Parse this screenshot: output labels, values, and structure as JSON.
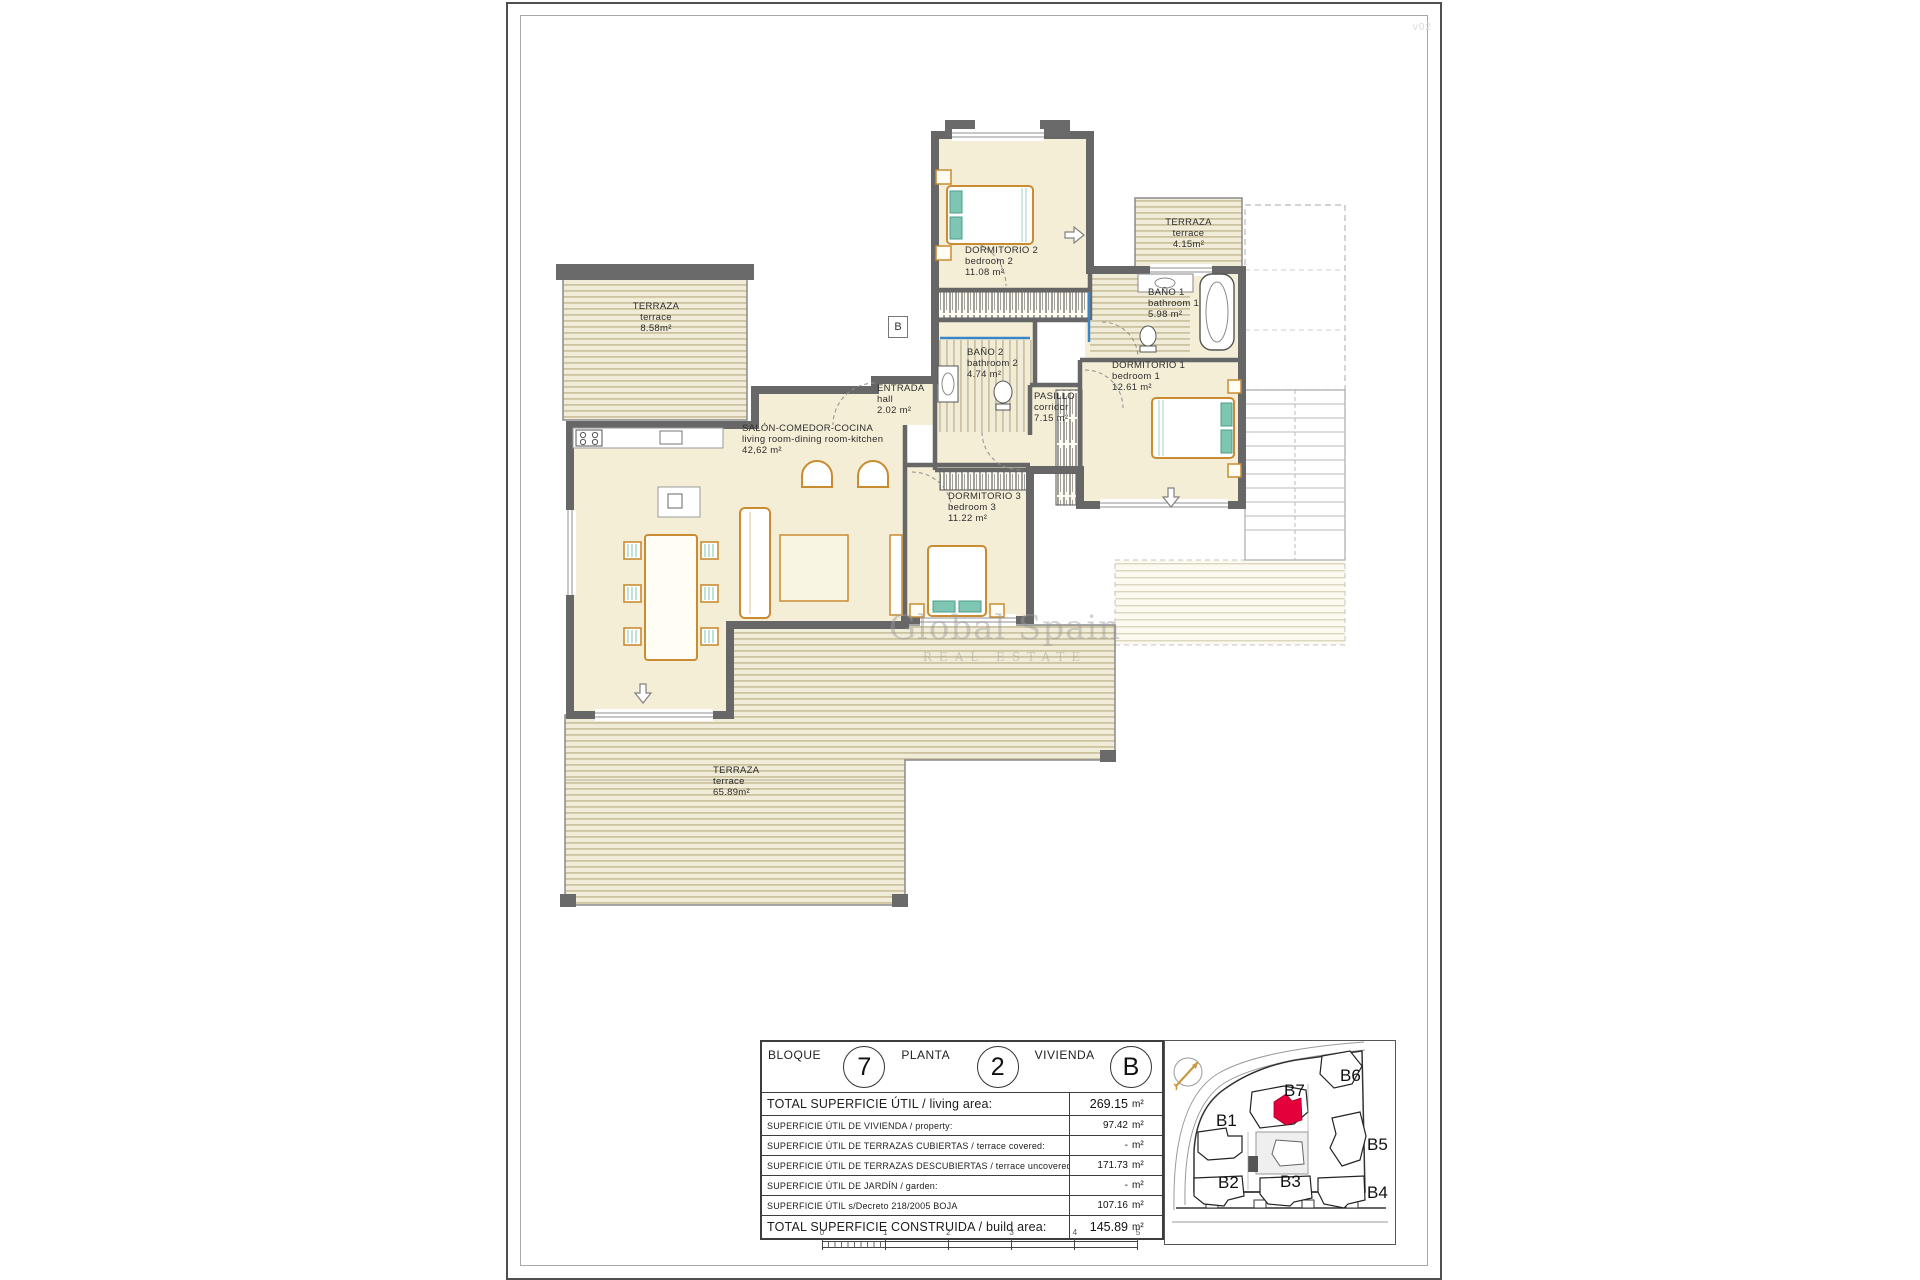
{
  "page": {
    "corner_note": "v02"
  },
  "watermark": {
    "line1": "Global Spain",
    "line2": "REAL ESTATE"
  },
  "plan": {
    "unit_marker": "B",
    "rooms": {
      "terraza_left": {
        "es": "TERRAZA",
        "en": "terrace",
        "area": "8.58m²"
      },
      "dorm2": {
        "es": "DORMITORIO 2",
        "en": "bedroom 2",
        "area": "11.08 m²"
      },
      "terraza_top": {
        "es": "TERRAZA",
        "en": "terrace",
        "area": "4.15m²"
      },
      "bano1": {
        "es": "BAÑO 1",
        "en": "bathroom 1",
        "area": "5.98 m²"
      },
      "dorm1": {
        "es": "DORMITORIO 1",
        "en": "bedroom 1",
        "area": "12.61 m²"
      },
      "pasillo": {
        "es": "PASILLO",
        "en": "corridor",
        "area": "7.15 m²"
      },
      "bano2": {
        "es": "BAÑO 2",
        "en": "bathroom 2",
        "area": "4.74 m²"
      },
      "entrada": {
        "es": "ENTRADA",
        "en": "hall",
        "area": "2.02 m²"
      },
      "salon": {
        "es": "SALÓN-COMEDOR-COCINA",
        "en": "living room-dining room-kitchen",
        "area": "42,62 m²"
      },
      "dorm3": {
        "es": "DORMITORIO 3",
        "en": "bedroom 3",
        "area": "11.22 m²"
      },
      "terraza_main": {
        "es": "TERRAZA",
        "en": "terrace",
        "area": "65.89m²"
      }
    }
  },
  "info_table": {
    "header": {
      "bloque_label": "BLOQUE",
      "bloque_value": "7",
      "planta_label": "PLANTA",
      "planta_value": "2",
      "vivienda_label": "VIVIENDA",
      "vivienda_value": "B"
    },
    "rows": [
      {
        "label": "TOTAL SUPERFICIE ÚTIL / living area:",
        "value": "269.15",
        "unit": "m²"
      },
      {
        "label": "SUPERFICIE ÚTIL DE VIVIENDA / property:",
        "value": "97.42",
        "unit": "m²"
      },
      {
        "label": "SUPERFICIE ÚTIL DE TERRAZAS CUBIERTAS / terrace covered:",
        "value": "-",
        "unit": "m²"
      },
      {
        "label": "SUPERFICIE ÚTIL DE TERRAZAS DESCUBIERTAS / terrace uncovered:",
        "value": "171.73",
        "unit": "m²"
      },
      {
        "label": "SUPERFICIE ÚTIL DE JARDÍN / garden:",
        "value": "-",
        "unit": "m²"
      },
      {
        "label": "SUPERFICIE ÚTIL s/Decreto 218/2005 BOJA",
        "value": "107.16",
        "unit": "m²"
      },
      {
        "label": "TOTAL SUPERFICIE CONSTRUIDA / build area:",
        "value": "145.89",
        "unit": "m²"
      }
    ]
  },
  "scale_bar": {
    "labels": [
      "0",
      "1",
      "2",
      "3",
      "4",
      "5"
    ]
  },
  "site_map": {
    "labels": [
      "B1",
      "B2",
      "B3",
      "B4",
      "B5",
      "B6",
      "B7"
    ]
  },
  "colors": {
    "room_fill": "#f4eed6",
    "wall": "#6a6a6a",
    "deck_stripe": "#cdc3a2",
    "furniture": "#c98c33",
    "teal_accent": "#7fc6b2",
    "blue_accent": "#3a85c8",
    "highlight_red": "#e4003a",
    "compass_gold": "#c89a3f"
  }
}
